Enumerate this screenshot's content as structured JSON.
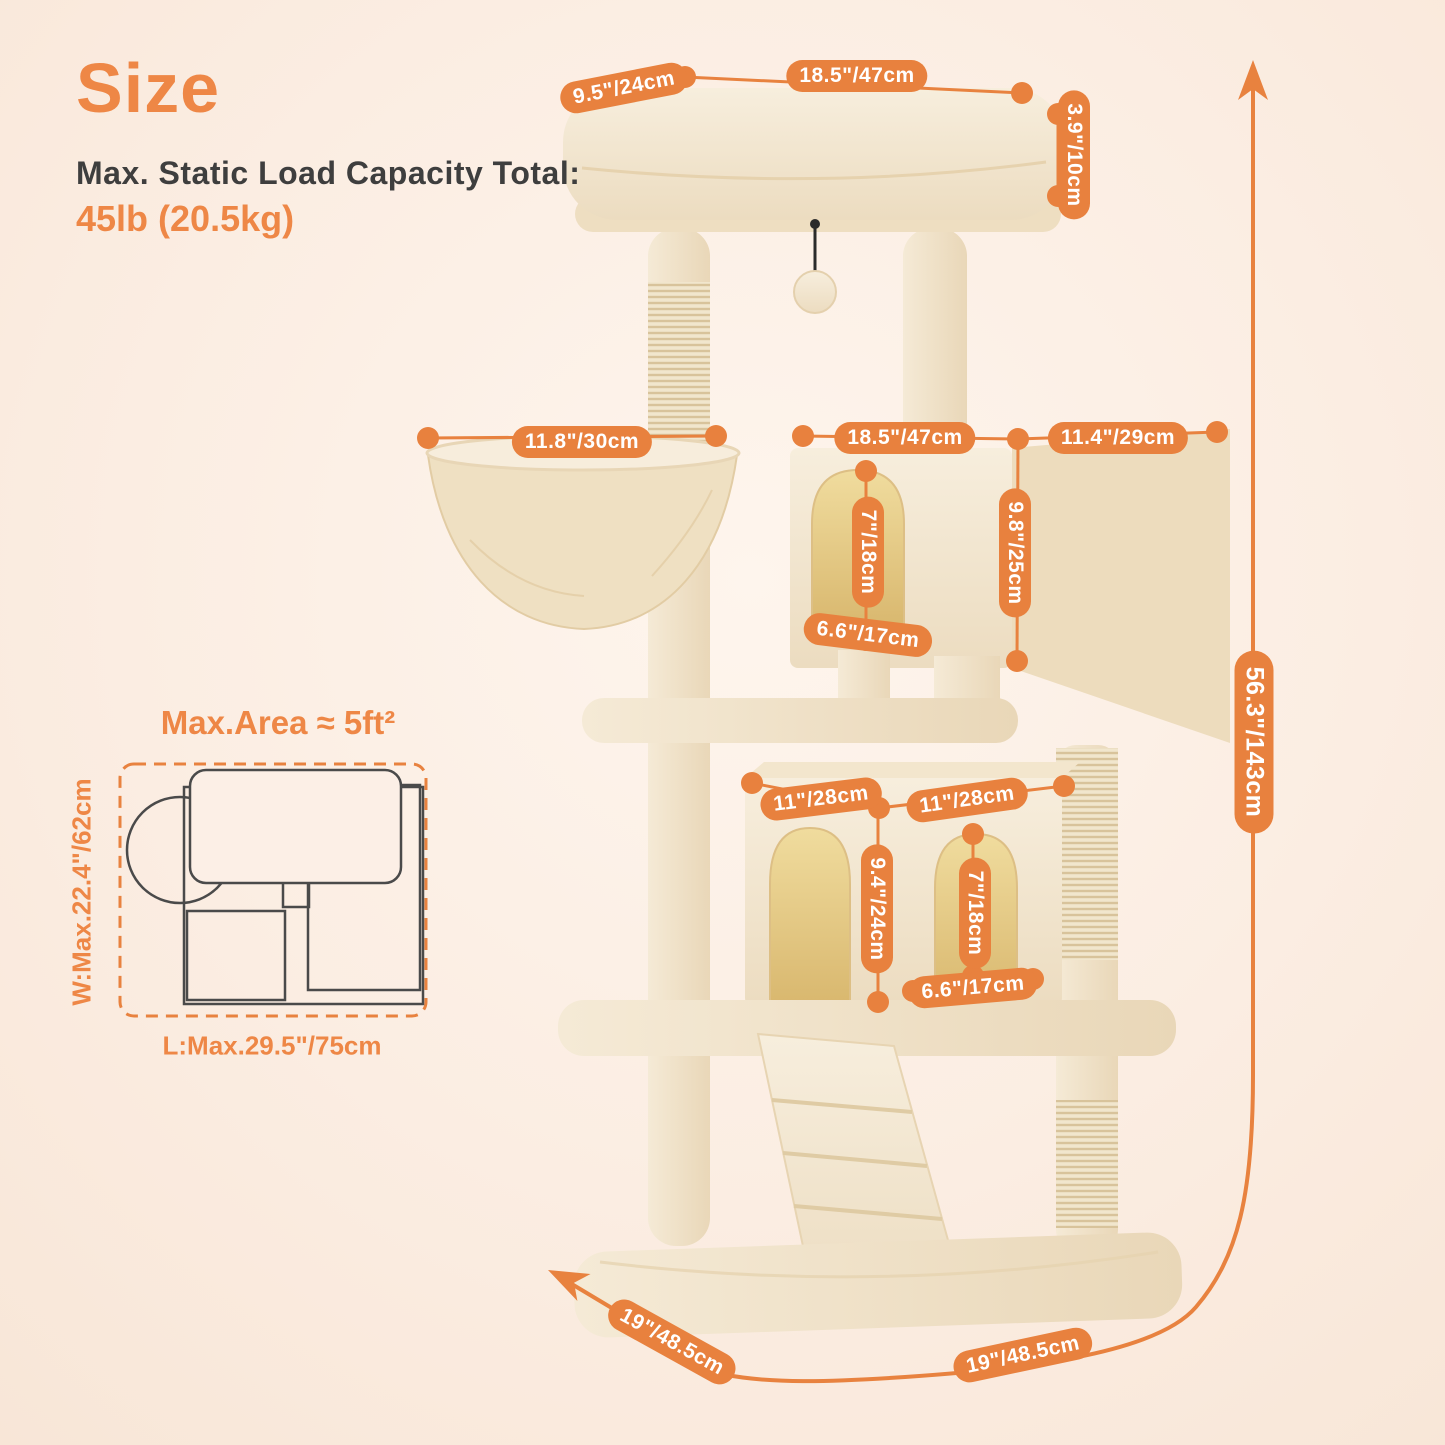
{
  "header": {
    "title": "Size",
    "subtitle": "Max. Static Load Capacity Total:",
    "capacity": "45lb (20.5kg)"
  },
  "floor_plan": {
    "title": "Max.Area ≈ 5ft²",
    "width_label": "W:Max.22.4\"/62cm",
    "length_label": "L:Max.29.5\"/75cm"
  },
  "dimensions": {
    "top_perch_depth": "9.5\"/24cm",
    "top_perch_width": "18.5\"/47cm",
    "top_perch_thickness": "3.9\"/10cm",
    "hammock_diameter": "11.8\"/30cm",
    "upper_condo_width": "18.5\"/47cm",
    "upper_condo_depth": "11.4\"/29cm",
    "upper_condo_height": "9.8\"/25cm",
    "upper_door_height": "7\"/18cm",
    "upper_door_width": "6.6\"/17cm",
    "lower_condo_width_left": "11\"/28cm",
    "lower_condo_width_right": "11\"/28cm",
    "lower_condo_height": "9.4\"/24cm",
    "lower_door_height": "7\"/18cm",
    "lower_door_width": "6.6\"/17cm",
    "total_height": "56.3\"/143cm",
    "base_depth": "19\"/48.5cm",
    "base_width": "19\"/48.5cm"
  },
  "colors": {
    "accent_text": "#EE8746",
    "pill": "#E8813E",
    "dimension_line": "#E8823F",
    "text_dark": "#3E3E3E",
    "background_center": "#FEF5ED",
    "background_edge": "#F8E6D7",
    "plush_light": "#F7EDDC",
    "plush_dark": "#E9D7B8",
    "floor_plan_stroke": "#4A4A4A"
  }
}
